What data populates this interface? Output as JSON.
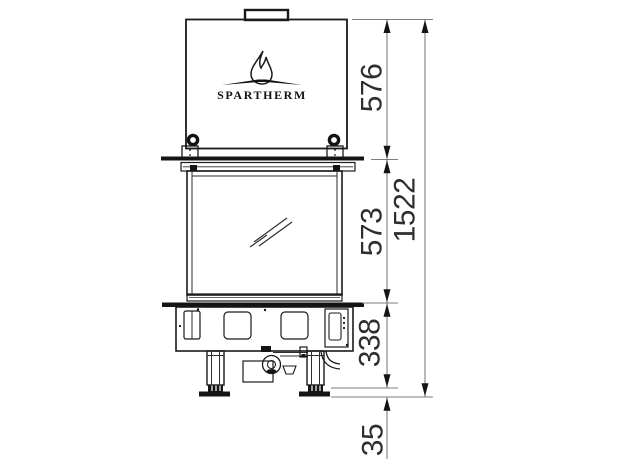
{
  "logo": {
    "brand": "SPARTHERM"
  },
  "dimensions": {
    "hood_height": "576",
    "firebox_height": "573",
    "base_height": "338",
    "floor_clearance": "35",
    "total_height": "1522"
  },
  "colors": {
    "outline": "#1a1a1a",
    "dimension_lines": "#7d7d7d",
    "text": "#2e2e2e",
    "background": "#ffffff"
  }
}
